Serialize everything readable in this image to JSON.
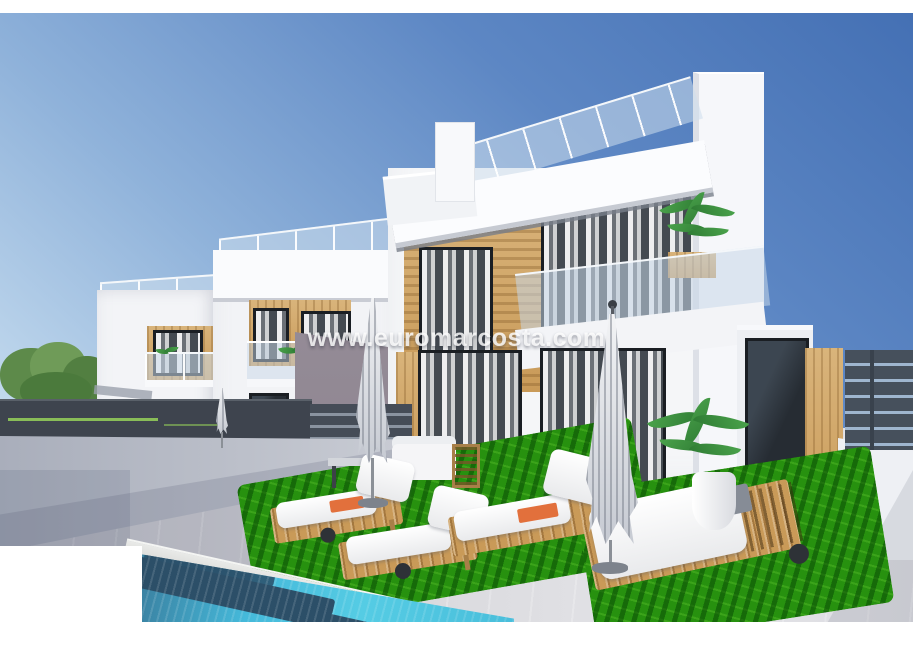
{
  "watermark": {
    "text": "www.euromarcosta.com"
  },
  "photo": {
    "colors": {
      "sky-top": "#4470b4",
      "sky-horizon": "#d9e8f5",
      "villa-white": "#f5f6f8",
      "villa-side": "#8e8591",
      "wood": "#c99a58",
      "window-dark": "#262c33",
      "fence-dark": "#3e444e",
      "wall-grey": "#c9ccd4",
      "terrace": "#d8d8dc",
      "grass": "#27910f",
      "pool-water": "#55cce4",
      "pool-step": "#2c4f68",
      "towel-orange": "#e2703c"
    }
  }
}
